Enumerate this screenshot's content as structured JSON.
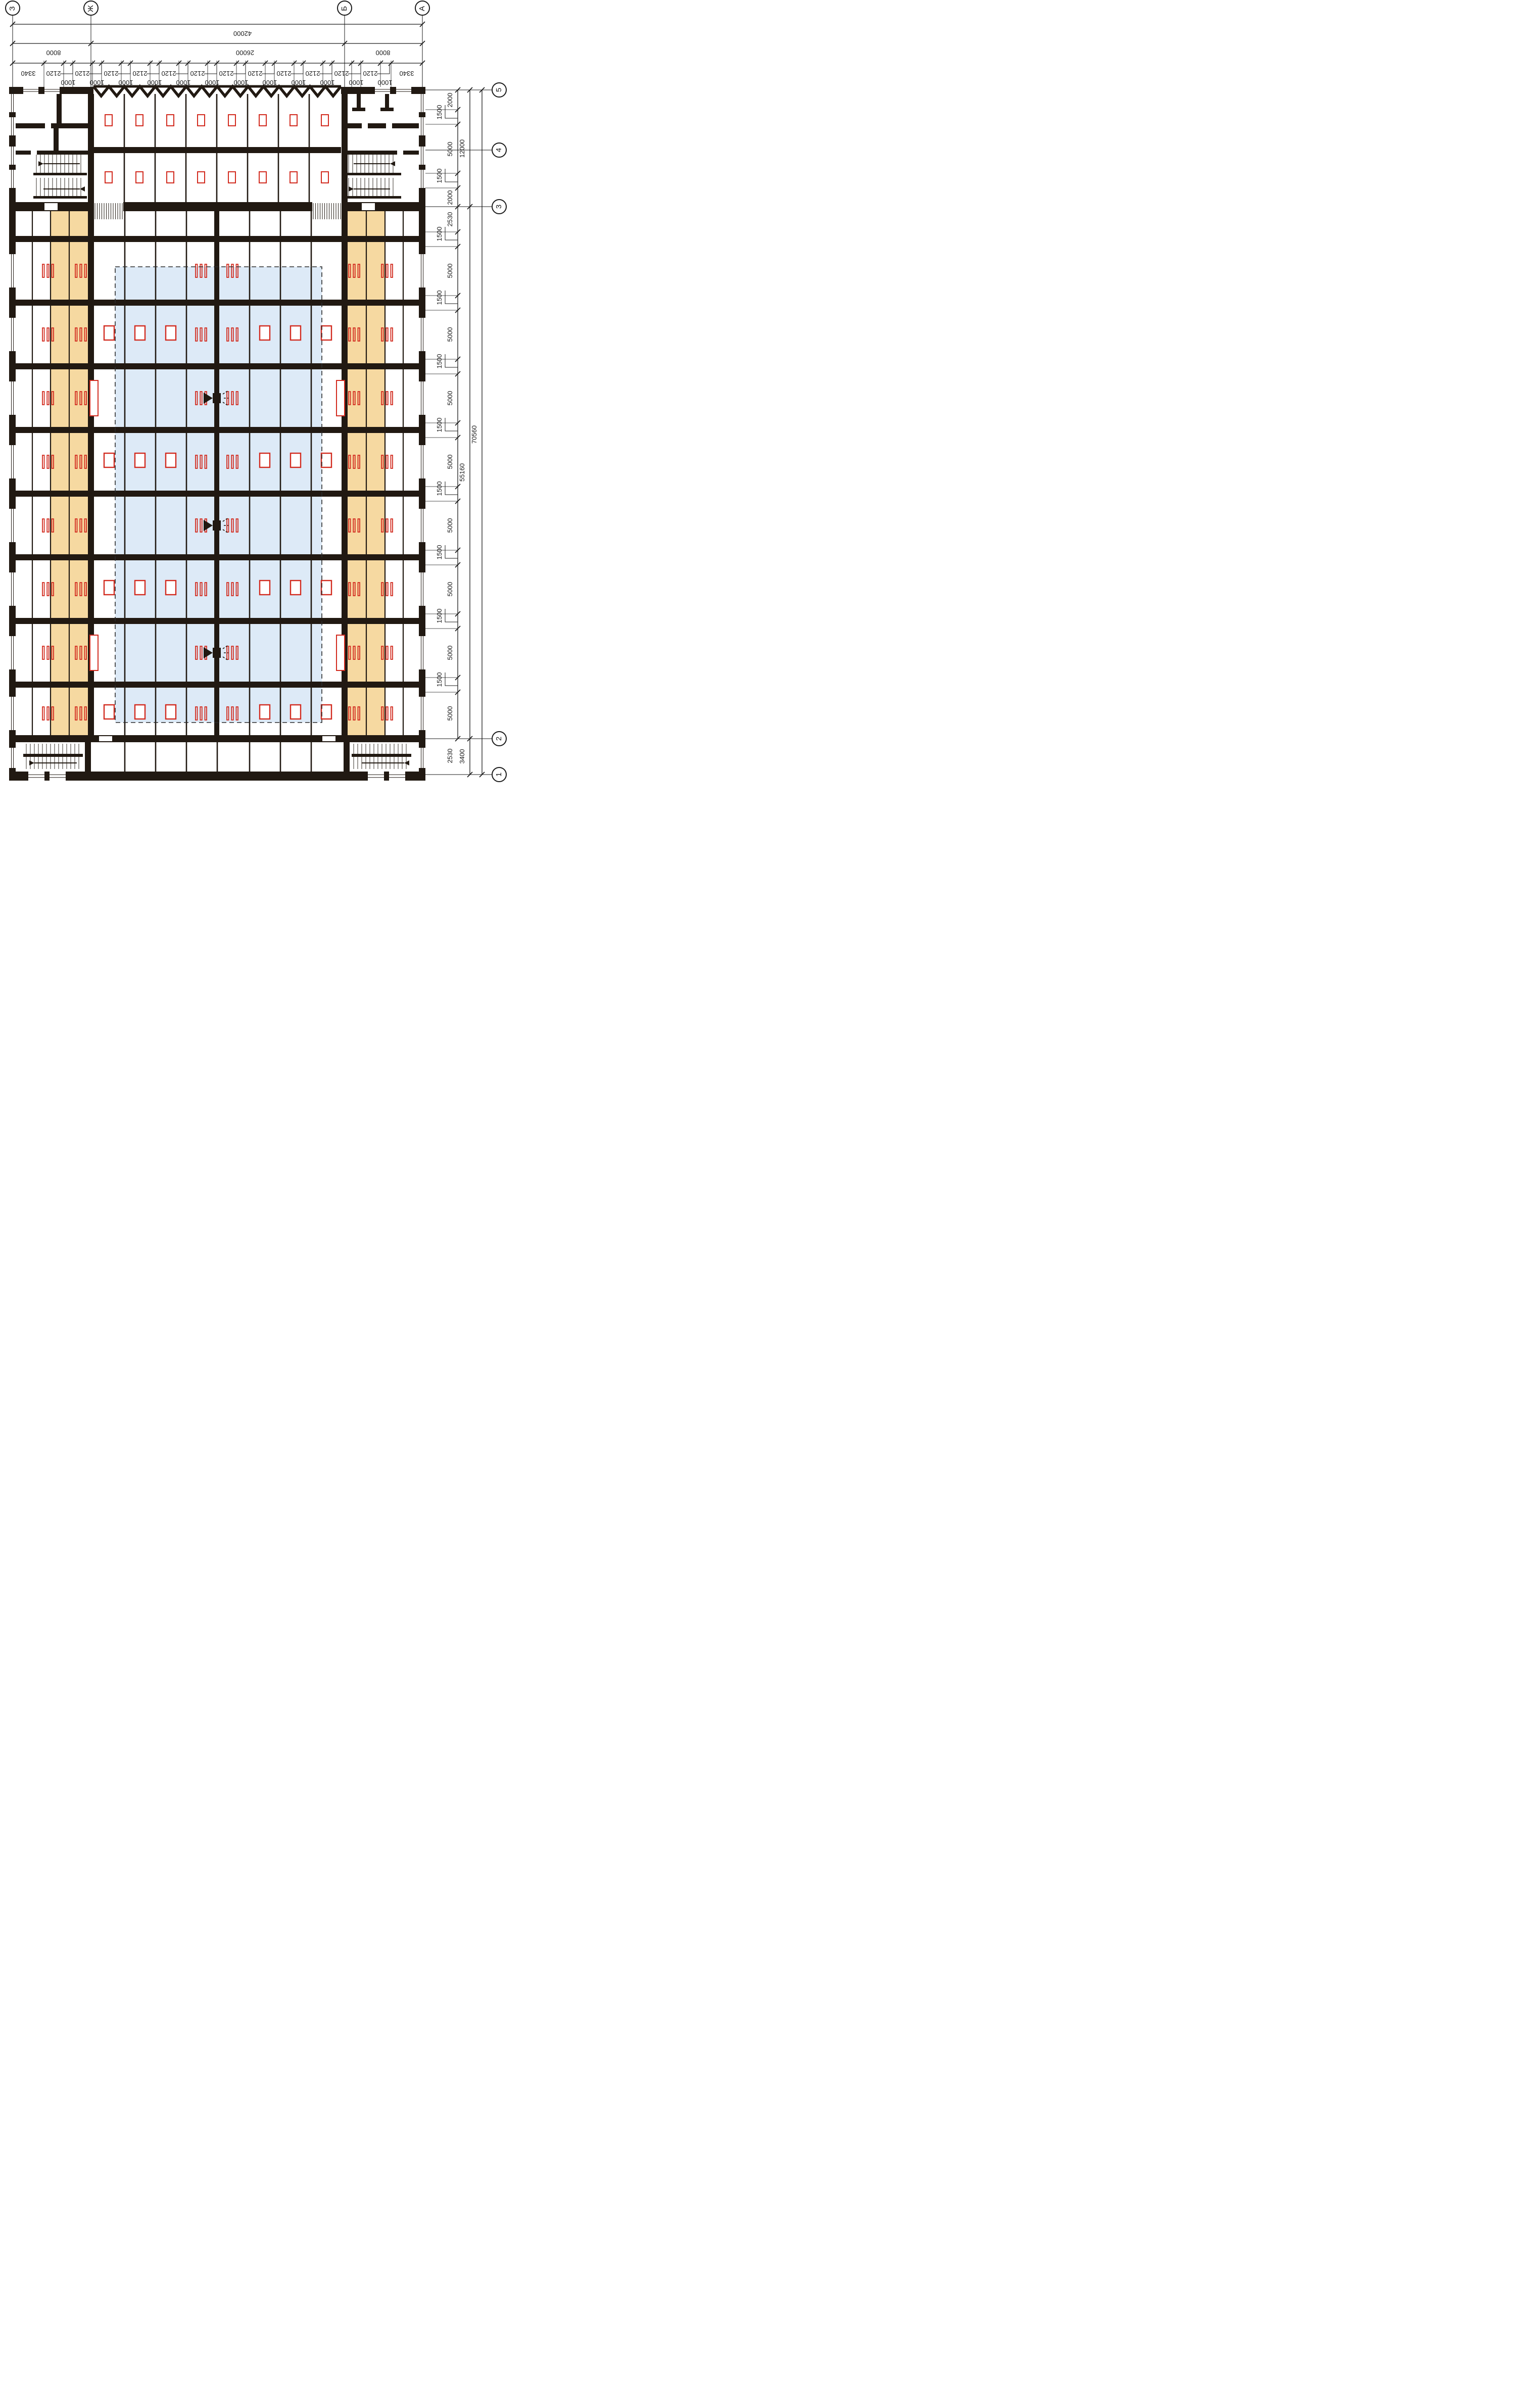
{
  "axes": {
    "letters": [
      "З",
      "Ж",
      "Б",
      "А"
    ],
    "numbers": [
      "5",
      "4",
      "3",
      "2",
      "1"
    ]
  },
  "top": {
    "total": "42000",
    "spans": [
      "8000",
      "26000",
      "8000"
    ],
    "corners": [
      "3340",
      "3340"
    ],
    "windows": [
      "2120",
      "2120",
      "2120",
      "2120",
      "2120",
      "2120",
      "2120",
      "2120",
      "2120",
      "2120",
      "2120",
      "2120"
    ],
    "piers": [
      "1000",
      "1000",
      "1000",
      "1000",
      "1000",
      "1000",
      "1000",
      "1000",
      "1000",
      "1000",
      "1000",
      "1000"
    ]
  },
  "right": {
    "outer": "70560",
    "middle": [
      "12000",
      "55160",
      "3400"
    ],
    "upper": [
      "2000",
      "1500",
      "5000",
      "1500",
      "2000"
    ],
    "first": "2530",
    "below": "2530",
    "bands": [
      "1500",
      "1500",
      "1500",
      "1500",
      "1500",
      "1500",
      "1500",
      "1500"
    ],
    "cells": [
      "5000",
      "5000",
      "5000",
      "5000",
      "5000",
      "5000",
      "5000",
      "5000"
    ]
  },
  "colors": {
    "wall": "#211912",
    "accent_red": "#d22b1f",
    "zone_orange": "#f6d9a1",
    "zone_blue": "#ddeaf7"
  }
}
